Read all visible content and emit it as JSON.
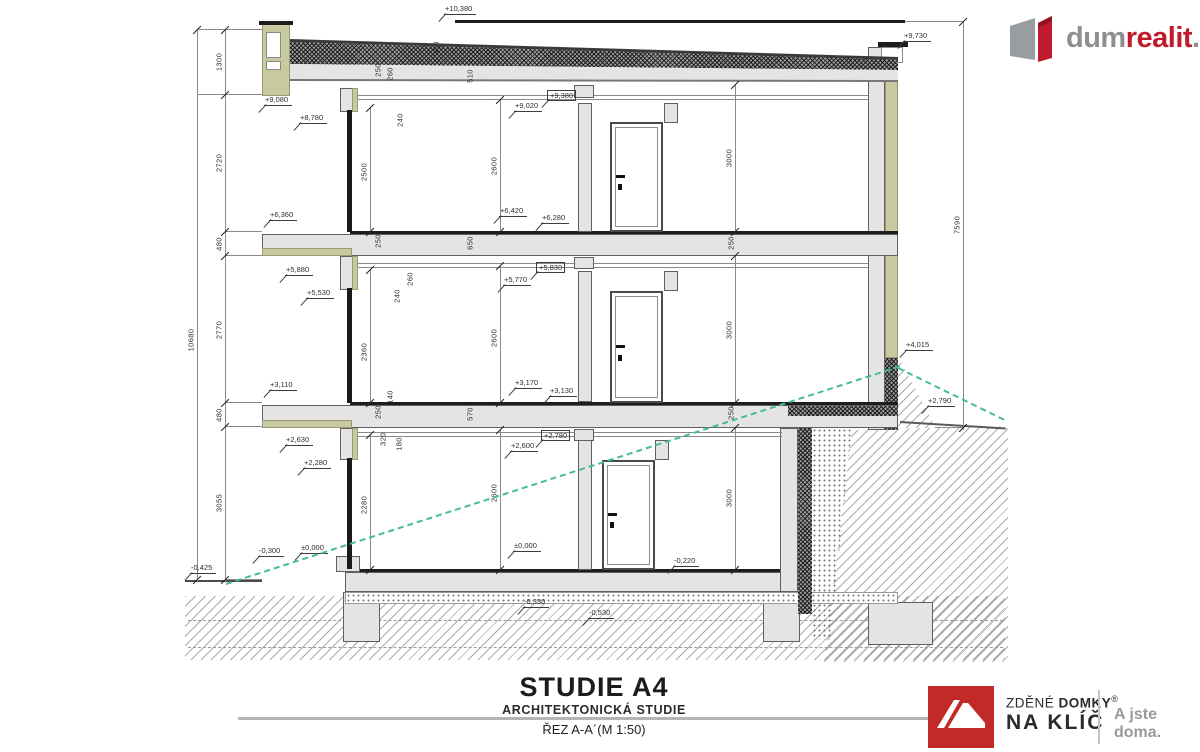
{
  "titleblock": {
    "title": "STUDIE A4",
    "subtitle": "ARCHITEKTONICKÁ STUDIE",
    "sheet": "ŘEZ A-A´(M 1:50)"
  },
  "brand_top": {
    "part1": "dum",
    "part2": "realit",
    "part3": ".cz"
  },
  "brand_bottom": {
    "line1_light": "ZDĚNÉ",
    "line1_bold": "DOMKY",
    "reg": "®",
    "line2": "NA KLÍČ",
    "tagline": "A jste doma."
  },
  "colors": {
    "brand_red": "#c01b2d",
    "logo_red": "#c22a28",
    "brand_gray": "#8d9091",
    "olive_accent": "#c9c9a0",
    "terrain_green": "#46bd8e"
  },
  "drawing": {
    "elevation_marks": [
      {
        "label": "+10,380",
        "x": 444,
        "y": 4
      },
      {
        "label": "+9,730",
        "x": 903,
        "y": 31
      },
      {
        "label": "+9,080",
        "x": 264,
        "y": 95
      },
      {
        "label": "+8,780",
        "x": 299,
        "y": 113
      },
      {
        "label": "+9,020",
        "x": 514,
        "y": 101
      },
      {
        "label": "+9,380",
        "x": 547,
        "y": 90,
        "boxed": true
      },
      {
        "label": "+6,360",
        "x": 269,
        "y": 210
      },
      {
        "label": "+6,420",
        "x": 499,
        "y": 206
      },
      {
        "label": "+6,280",
        "x": 541,
        "y": 213
      },
      {
        "label": "+5,880",
        "x": 285,
        "y": 265
      },
      {
        "label": "+5,530",
        "x": 306,
        "y": 288
      },
      {
        "label": "+5,770",
        "x": 503,
        "y": 275
      },
      {
        "label": "+5,830",
        "x": 536,
        "y": 262,
        "boxed": true
      },
      {
        "label": "+3,110",
        "x": 269,
        "y": 380
      },
      {
        "label": "+3,170",
        "x": 514,
        "y": 378
      },
      {
        "label": "+3,130",
        "x": 549,
        "y": 386
      },
      {
        "label": "+2,630",
        "x": 285,
        "y": 435
      },
      {
        "label": "+2,280",
        "x": 303,
        "y": 458
      },
      {
        "label": "+2,780",
        "x": 541,
        "y": 430,
        "boxed": true
      },
      {
        "label": "+2,600",
        "x": 510,
        "y": 441
      },
      {
        "label": "+4,015",
        "x": 905,
        "y": 340
      },
      {
        "label": "+2,790",
        "x": 927,
        "y": 396
      },
      {
        "label": "±0,000",
        "x": 300,
        "y": 543
      },
      {
        "label": "±0,000",
        "x": 513,
        "y": 541
      },
      {
        "label": "-0,220",
        "x": 673,
        "y": 556
      },
      {
        "label": "-0,300",
        "x": 258,
        "y": 546
      },
      {
        "label": "-0,425",
        "x": 190,
        "y": 563
      },
      {
        "label": "-0,330",
        "x": 523,
        "y": 597
      },
      {
        "label": "-0,530",
        "x": 588,
        "y": 608
      }
    ],
    "dimensions": [
      {
        "label": "10680",
        "x": 191,
        "y": 340
      },
      {
        "label": "1300",
        "x": 219,
        "y": 62
      },
      {
        "label": "2720",
        "x": 219,
        "y": 163
      },
      {
        "label": "480",
        "x": 219,
        "y": 244
      },
      {
        "label": "2770",
        "x": 219,
        "y": 330
      },
      {
        "label": "480",
        "x": 219,
        "y": 415
      },
      {
        "label": "3055",
        "x": 219,
        "y": 503
      },
      {
        "label": "7590",
        "x": 957,
        "y": 225
      },
      {
        "label": "2500",
        "x": 364,
        "y": 172
      },
      {
        "label": "2600",
        "x": 494,
        "y": 166
      },
      {
        "label": "3000",
        "x": 729,
        "y": 158
      },
      {
        "label": "2360",
        "x": 364,
        "y": 352
      },
      {
        "label": "2600",
        "x": 494,
        "y": 338
      },
      {
        "label": "3000",
        "x": 729,
        "y": 330
      },
      {
        "label": "2280",
        "x": 364,
        "y": 505
      },
      {
        "label": "2600",
        "x": 494,
        "y": 493
      },
      {
        "label": "3000",
        "x": 729,
        "y": 498
      },
      {
        "label": "350",
        "x": 436,
        "y": 48
      },
      {
        "label": "250",
        "x": 378,
        "y": 70
      },
      {
        "label": "260",
        "x": 390,
        "y": 74
      },
      {
        "label": "510",
        "x": 470,
        "y": 76
      },
      {
        "label": "240",
        "x": 400,
        "y": 120
      },
      {
        "label": "250",
        "x": 378,
        "y": 241
      },
      {
        "label": "650",
        "x": 470,
        "y": 243
      },
      {
        "label": "260",
        "x": 410,
        "y": 279
      },
      {
        "label": "240",
        "x": 397,
        "y": 296
      },
      {
        "label": "140",
        "x": 390,
        "y": 397
      },
      {
        "label": "250",
        "x": 731,
        "y": 243
      },
      {
        "label": "250",
        "x": 378,
        "y": 412
      },
      {
        "label": "570",
        "x": 470,
        "y": 414
      },
      {
        "label": "320",
        "x": 383,
        "y": 439
      },
      {
        "label": "180",
        "x": 399,
        "y": 444
      },
      {
        "label": "250",
        "x": 731,
        "y": 413
      }
    ]
  }
}
